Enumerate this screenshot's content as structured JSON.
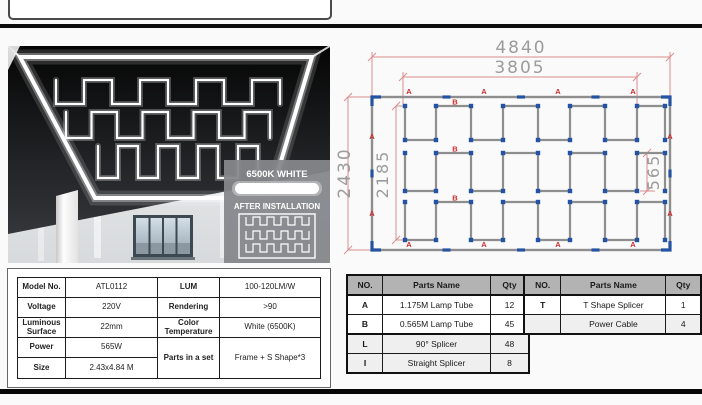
{
  "photo": {
    "overlay": {
      "temp": "6500K WHITE",
      "after": "AFTER INSTALLATION"
    }
  },
  "diagram": {
    "dim_outer_w": "4840",
    "dim_inner_w": "3805",
    "dim_outer_h": "2430",
    "dim_inner_h": "2185",
    "dim_segment": "565",
    "label_frame_tube": "A",
    "label_wave_tube": "B"
  },
  "spec": {
    "r1": {
      "l1": "Model No.",
      "v1": "ATL0112",
      "l2": "LUM",
      "v2": "100-120LM/W"
    },
    "r2": {
      "l1": "Voltage",
      "v1": "220V",
      "l2": "Rendering",
      "v2": ">90"
    },
    "r3": {
      "l1": "Luminous Surface",
      "v1": "22mm",
      "l2": "Color Temperature",
      "v2": "White (6500K)"
    },
    "r4": {
      "l1": "Power",
      "v1": "565W",
      "l2": "Parts in a set",
      "v2": "Frame + S Shape*3"
    },
    "r5": {
      "l1": "Size",
      "v1": "2.43x4.84 M"
    }
  },
  "parts1": {
    "headers": [
      "NO.",
      "Parts Name",
      "Qty"
    ],
    "rows": [
      [
        "A",
        "1.175M Lamp Tube",
        "12"
      ],
      [
        "B",
        "0.565M Lamp Tube",
        "45"
      ],
      [
        "L",
        "90° Splicer",
        "48"
      ],
      [
        "I",
        "Straight Splicer",
        "8"
      ]
    ]
  },
  "parts2": {
    "headers": [
      "NO.",
      "Parts Name",
      "Qty"
    ],
    "rows": [
      [
        "T",
        "T Shape Splicer",
        "1"
      ],
      [
        "",
        "Power Cable",
        "4"
      ]
    ]
  },
  "colors": {
    "splicer_blue": "#2353a2",
    "tube_gray": "#8e8e8e",
    "dim_red": "#d98c8c",
    "label_red": "#cf2b2b",
    "table_header_gray": "#b3b3b3"
  }
}
